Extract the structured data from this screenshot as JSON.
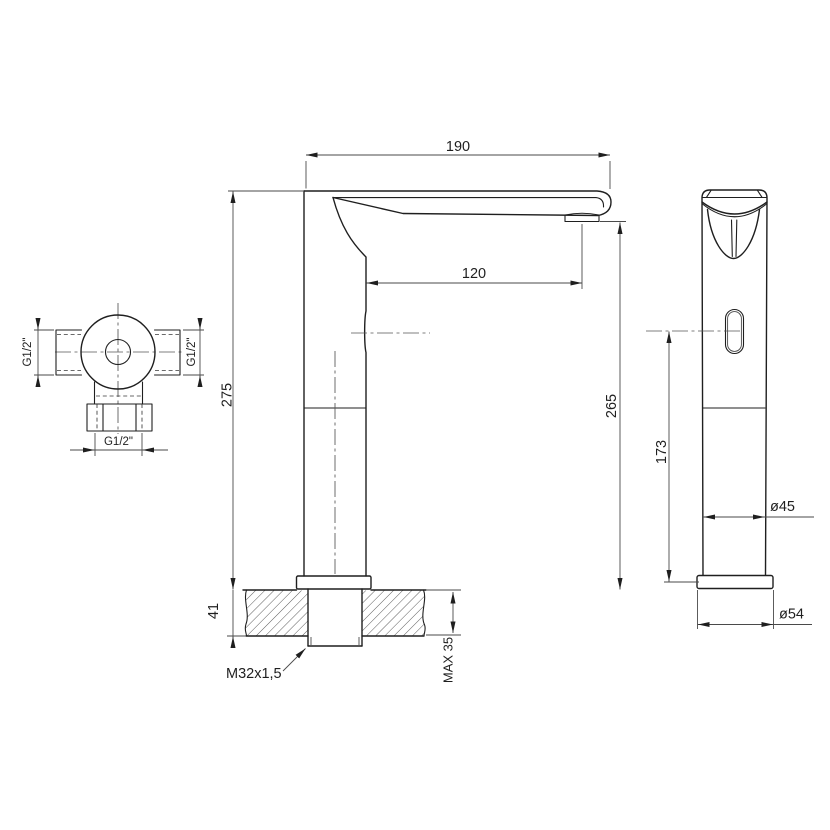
{
  "drawing": {
    "type": "technical-drawing",
    "subject": "sensor basin mixer faucet dimensional drawing",
    "background_color": "#ffffff",
    "line_color": "#1f1f1f",
    "views": {
      "top_view": {
        "name": "valve body top view",
        "left_port_label": "G1/2\"",
        "right_port_label": "G1/2\"",
        "bottom_port_label": "G1/2\""
      },
      "side_view": {
        "name": "faucet side view",
        "spout_width": "190",
        "spout_reach": "120",
        "height_total": "275",
        "height_outlet": "265",
        "deck_section": "41",
        "thread_label": "M32x1,5",
        "max_deck_thickness": "MAX 35"
      },
      "front_view": {
        "name": "faucet front view",
        "sensor_height": "173",
        "body_diameter": "ø45",
        "base_diameter": "ø54"
      }
    }
  }
}
